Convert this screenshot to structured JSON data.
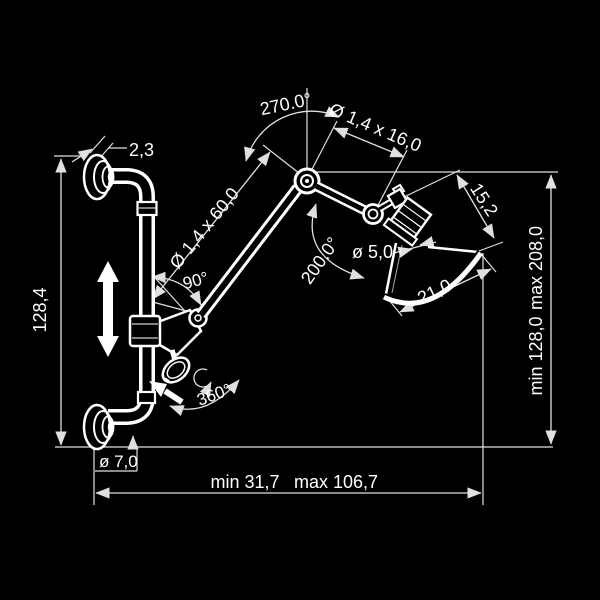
{
  "drawing": {
    "type": "technical-dimension-drawing",
    "subject": "wall-mounted articulating lamp",
    "colors": {
      "background": "#000000",
      "line": "#ffffff",
      "dim_line": "#e0e0e0"
    },
    "dims": {
      "flange_thickness": "2,3",
      "arm_swivel_angle": "270.0°",
      "upper_arm_tube": "Ø 1,4 x 16,0",
      "lower_arm_tube": "Ø 1,4 x 60,0",
      "shade_height": "15,2",
      "head_tilt_angle": "200.0°",
      "socket_diameter": "ø 5,0",
      "shade_diameter": "21,0",
      "wall_bar_length": "128,4",
      "height_min": "min 128,0",
      "height_max": "max 208,0",
      "arm_fold_angle": "90°",
      "knob_rotation": "360°",
      "tube_diameter": "ø 7,0",
      "reach_min": "min 31,7",
      "reach_max": "max 106,7"
    }
  }
}
